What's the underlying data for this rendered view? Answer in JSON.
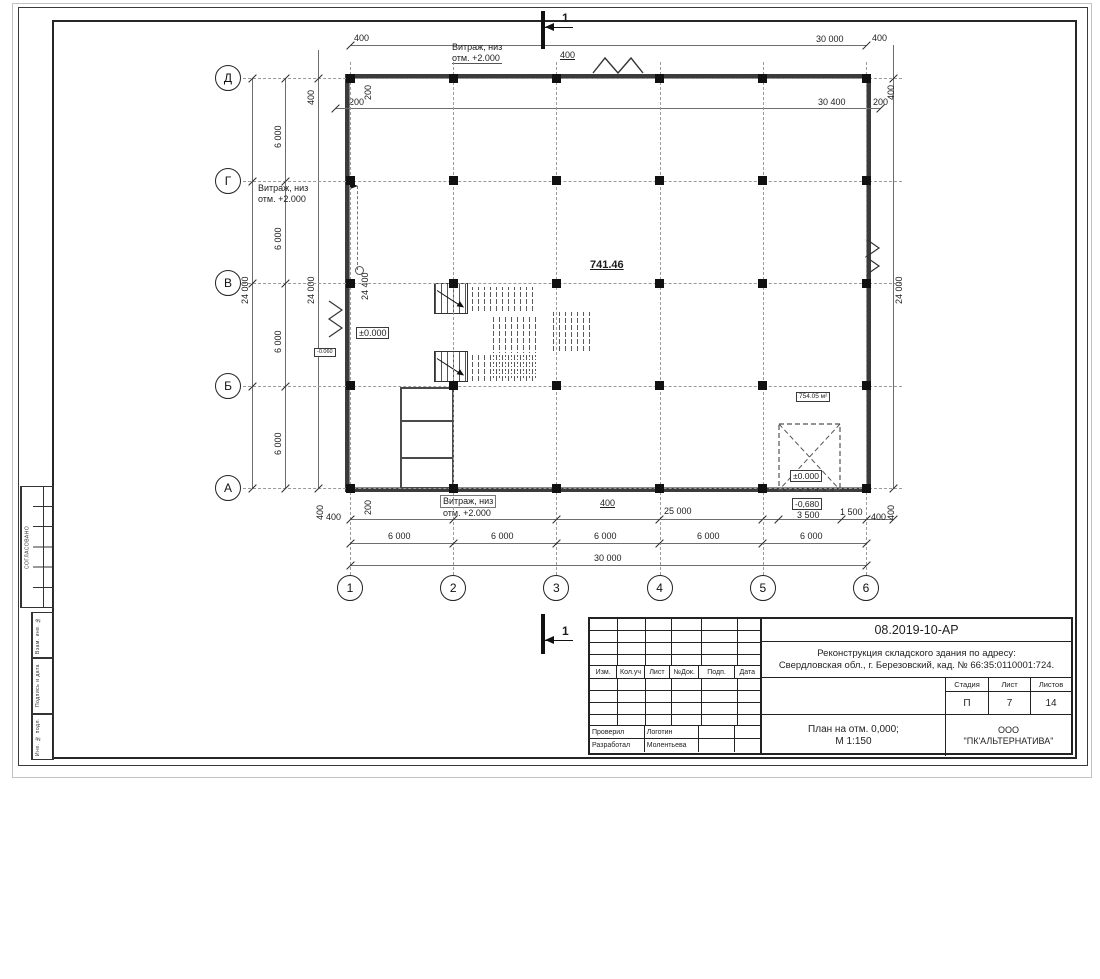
{
  "axes": {
    "rows": [
      "Д",
      "Г",
      "В",
      "Б",
      "А"
    ],
    "cols": [
      "1",
      "2",
      "3",
      "4",
      "5",
      "6"
    ]
  },
  "dims": {
    "d400": "400",
    "d200": "200",
    "d6000": "6 000",
    "d24000": "24 000",
    "d30000": "30 000",
    "d30400": "30 400",
    "d24400": "24 400",
    "d25000": "25 000",
    "d3500": "3 500",
    "d1500": "1 500"
  },
  "annotations": {
    "vitrazh_line1": "Витраж, низ",
    "vitrazh_line2": "отм. +2.000",
    "elev_zero": "±0.000",
    "elev_minus680": "-0,680",
    "elev_minus060": "-0.060",
    "area_741": "741.46",
    "area_754": "754.05 м²",
    "section_mark": "1"
  },
  "side_stamp": {
    "approved": "СОГЛАСОВАНО",
    "label1": "Взам. инв. №",
    "label2": "Подпись и дата",
    "label3": "Инв. № подл."
  },
  "title_block": {
    "doc_number": "08.2019-10-АР",
    "project_line1": "Реконструкция складского здания по адресу:",
    "project_line2": "Свердловская обл., г. Березовский, кад. № 66:35:0110001:724.",
    "cols": [
      "Изм.",
      "Кол.уч",
      "Лист",
      "№Док.",
      "Подп.",
      "Дата"
    ],
    "stage_label": "Стадия",
    "sheet_label": "Лист",
    "sheets_label": "Листов",
    "stage": "П",
    "sheet": "7",
    "sheets": "14",
    "title_line1": "План на отм. 0,000;",
    "title_line2": "М 1:150",
    "company_line1": "ООО",
    "company_line2": "\"ПК'АЛЬТЕРНАТИВА\"",
    "checked_label": "Проверил",
    "checked_name": "Логотин",
    "developed_label": "Разработал",
    "developed_name": "Молентьева"
  },
  "colors": {
    "line": "#3a3a3a",
    "grid": "#9a9a9a",
    "paper": "#ffffff"
  }
}
